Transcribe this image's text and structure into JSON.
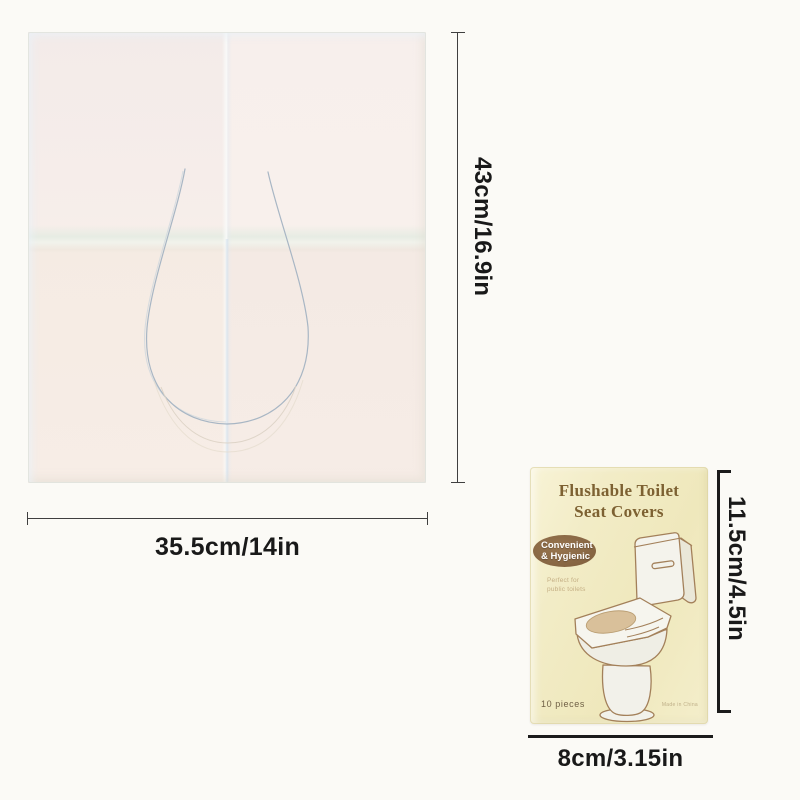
{
  "product_sheet": {
    "width_label": "35.5cm/14in",
    "height_label": "43cm/16.9in"
  },
  "package": {
    "title_line1": "Flushable Toilet",
    "title_line2": "Seat Covers",
    "badge": {
      "line1": "Convenient",
      "line2": "& Hygienic"
    },
    "tagline_line1": "Perfect for",
    "tagline_line2": "public toilets",
    "pieces_label": "10 pieces",
    "origin_label": "Made in China",
    "width_label": "8cm/3.15in",
    "height_label": "11.5cm/4.5in"
  },
  "colors": {
    "page_background": "#fbfaf6",
    "sheet_base": "#f6ece8",
    "sheet_cutout_line": "#a8b6c4",
    "package_base": "#f1ebc2",
    "package_title_text": "#7d6132",
    "package_badge": "#8a6749",
    "toilet_outline": "#a3805a",
    "dimension_text": "#191919"
  }
}
